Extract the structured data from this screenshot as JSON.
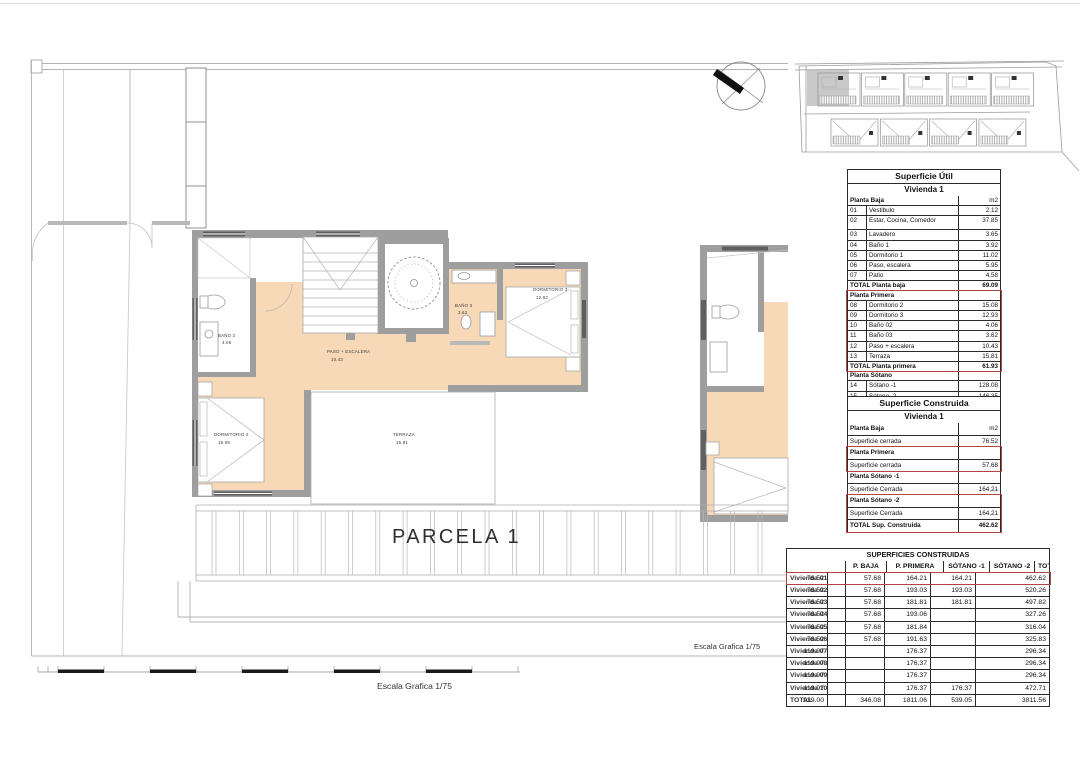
{
  "colors": {
    "accent_red": "#B2453F",
    "floor_peach": "#F7D9B7",
    "wall_gray": "#9E9E9E"
  },
  "floor_plan": {
    "parcel_label": "PARCELA 1",
    "scale_label_plan": "Escala Grafica 1/75",
    "scale_label_bar": "Escala Grafica 1/75",
    "rooms": {
      "bano2": {
        "label": "BAÑO 2",
        "area": "4.06"
      },
      "paso": {
        "label": "PASO + ESCALERA",
        "area": "10.43"
      },
      "dormitorio2": {
        "label": "DORMITORIO 2",
        "area": "15.08"
      },
      "bano3": {
        "label": "BAÑO 3",
        "area": "3.62"
      },
      "dormitorio3": {
        "label": "DORMITORIO 3",
        "area": "12.93"
      },
      "terraza": {
        "label": "TERRAZA",
        "area": "15.81"
      }
    }
  },
  "superficie_util": {
    "title": "Superficie Útil",
    "subtitle": "Vivienda 1",
    "unit": "m2",
    "sections": [
      {
        "header": "Planta Baja",
        "show_unit": true,
        "highlight": false,
        "rows": [
          [
            "01",
            "Vestibulo",
            "2.12"
          ],
          [
            "02",
            "Estar, Cocina, Comedor",
            "37.85"
          ],
          [
            "03",
            "Lavadero",
            "3.65"
          ],
          [
            "04",
            "Baño 1",
            "3.92"
          ],
          [
            "05",
            "Dormitorio 1",
            "11.02"
          ],
          [
            "06",
            "Paso, escalera",
            "5.95"
          ],
          [
            "07",
            "Patio",
            "4.58"
          ]
        ],
        "total": {
          "label": "TOTAL Planta baja",
          "value": "69.09"
        }
      },
      {
        "header": "Planta Primera",
        "show_unit": false,
        "highlight": true,
        "rows": [
          [
            "08",
            "Dormitorio 2",
            "15.08"
          ],
          [
            "09",
            "Dormitorio 3",
            "12.93"
          ],
          [
            "10",
            "Baño 02",
            "4.06"
          ],
          [
            "11",
            "Baño 03",
            "3.62"
          ],
          [
            "12",
            "Paso + escalera",
            "10.43"
          ],
          [
            "13",
            "Terraza",
            "15.81"
          ]
        ],
        "total": {
          "label": "TOTAL Planta primera",
          "value": "61.93"
        }
      },
      {
        "header": "Planta Sótano",
        "show_unit": false,
        "highlight": false,
        "rows": [
          [
            "14",
            "Sótano -1",
            "128.08"
          ],
          [
            "15",
            "Sótano -2",
            "146.35"
          ]
        ],
        "total": {
          "label": "TOTAL",
          "value": "405.45"
        }
      }
    ]
  },
  "superficie_construida": {
    "title": "Superficie Construida",
    "subtitle": "Vivienda 1",
    "sections": [
      {
        "highlight": false,
        "rows": [
          [
            "Planta Baja",
            "m2"
          ],
          [
            "Superficie cerrada",
            "76.52"
          ]
        ]
      },
      {
        "highlight": true,
        "rows": [
          [
            "Planta Primera",
            ""
          ],
          [
            "Superficie cerrada",
            "57.68"
          ]
        ]
      },
      {
        "highlight": false,
        "rows": [
          [
            "Planta Sótano -1",
            ""
          ],
          [
            "Superficie Cerrada",
            "164,21"
          ]
        ]
      },
      {
        "highlight": true,
        "rows": [
          [
            "Planta Sótano -2",
            ""
          ],
          [
            "Superficie Cerrada",
            "164,21"
          ],
          [
            "TOTAL Sup. Construida",
            "462.62"
          ]
        ]
      }
    ]
  },
  "superficies_construidas": {
    "title": "SUPERFICIES CONSTRUIDAS",
    "headers": [
      "",
      "P. BAJA",
      "P. PRIMERA",
      "SÓTANO -1",
      "SÓTANO -2",
      "TOTAL"
    ],
    "rows": [
      {
        "label": "Vivienda 01",
        "values": [
          "76.52",
          "57.68",
          "164.21",
          "164.21",
          "462.62"
        ],
        "highlight": true
      },
      {
        "label": "Vivienda 02",
        "values": [
          "76.52",
          "57.68",
          "193.03",
          "193.03",
          "520.26"
        ]
      },
      {
        "label": "Vivienda 03",
        "values": [
          "76.52",
          "57.68",
          "181.81",
          "181.81",
          "497.82"
        ]
      },
      {
        "label": "Vivienda 04",
        "values": [
          "76.52",
          "57.68",
          "193.06",
          "",
          "327.26"
        ]
      },
      {
        "label": "Vivienda 05",
        "values": [
          "76.52",
          "57.68",
          "181.84",
          "",
          "316.04"
        ]
      },
      {
        "label": "Vivienda 06",
        "values": [
          "76.52",
          "57.68",
          "191.63",
          "",
          "325.83"
        ]
      },
      {
        "label": "Vivienda 07",
        "values": [
          "119.97",
          "",
          "176.37",
          "",
          "296.34"
        ]
      },
      {
        "label": "Vivienda 08",
        "values": [
          "119.97",
          "",
          "176.37",
          "",
          "296.34"
        ]
      },
      {
        "label": "Vivienda 09",
        "values": [
          "119.97",
          "",
          "176.37",
          "",
          "296.34"
        ]
      },
      {
        "label": "Vivienda 10",
        "values": [
          "119.97",
          "",
          "176.37",
          "176.37",
          "472.71"
        ]
      },
      {
        "label": "TOTAL",
        "values": [
          "939.00",
          "346.08",
          "1811.06",
          "539.05",
          "3811.56"
        ],
        "is_total": true
      }
    ]
  }
}
